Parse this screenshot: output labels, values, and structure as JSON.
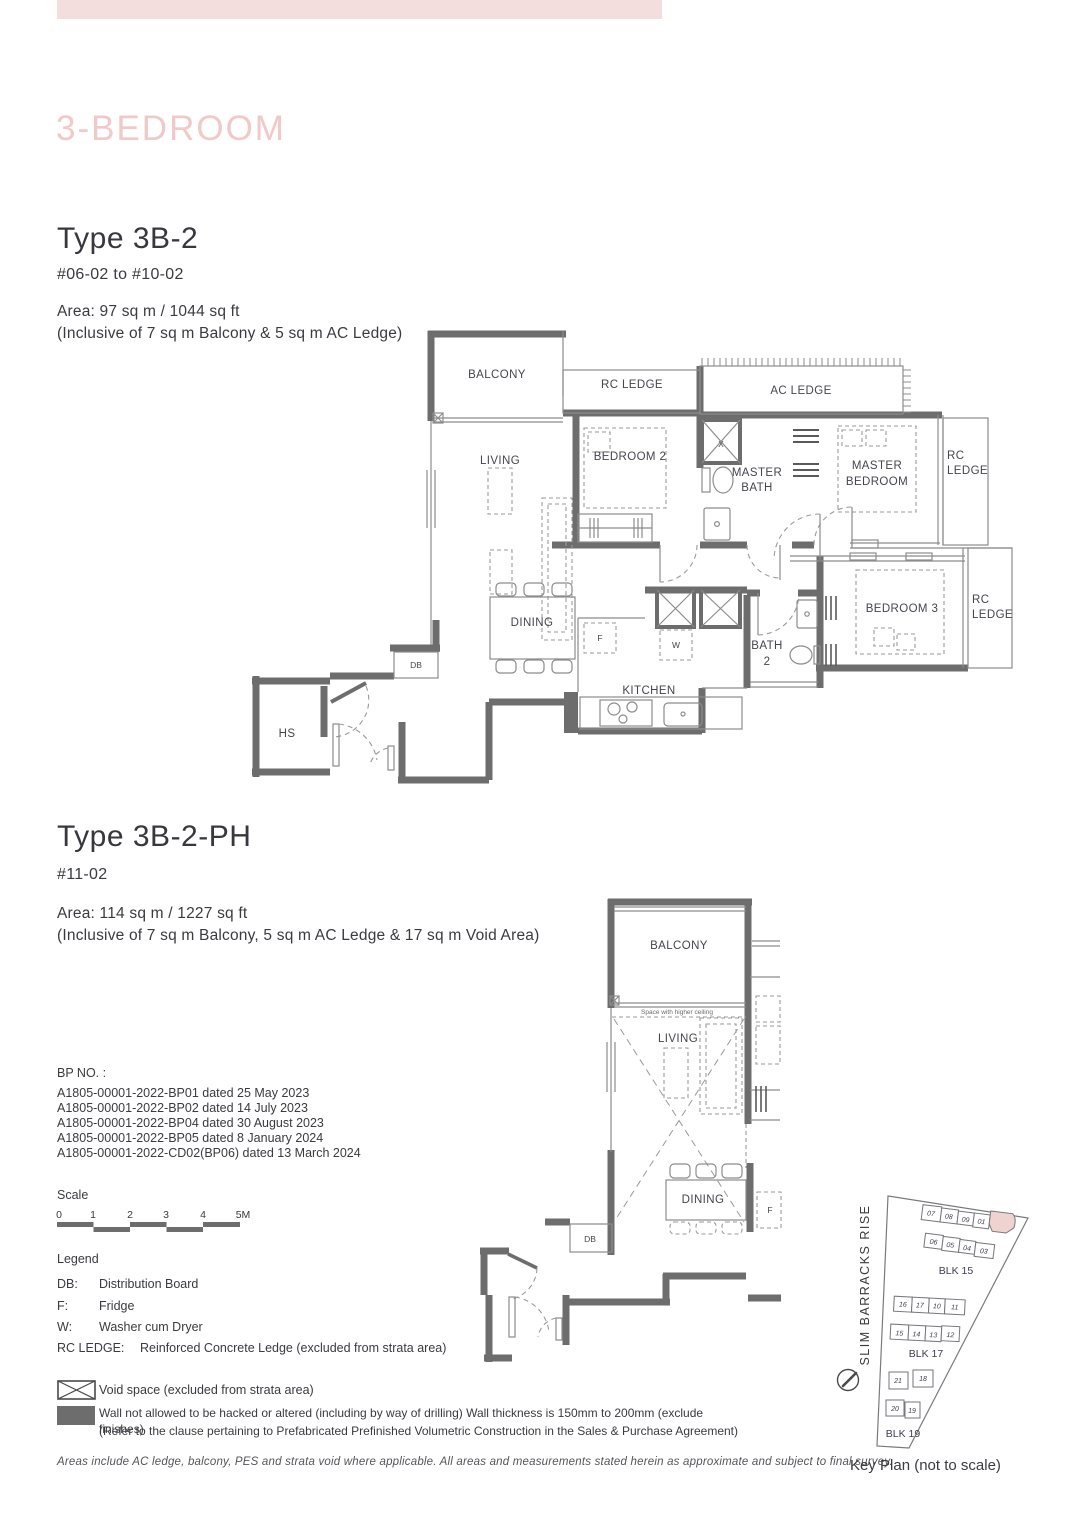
{
  "page": {
    "top_bar_color": "#f3dedd",
    "title": "3-BEDROOM",
    "footer": "Areas include AC ledge, balcony, PES and strata void where applicable. All areas and measurements stated herein as approximate and subject to final survey."
  },
  "unit_a": {
    "title": "Type 3B-2",
    "floors": "#06-02 to #10-02",
    "area1": "Area: 97 sq m / 1044 sq ft",
    "area2": "(Inclusive of 7 sq m Balcony & 5 sq m AC Ledge)"
  },
  "unit_b": {
    "title": "Type 3B-2-PH",
    "floors": "#11-02",
    "area1": "Area: 114 sq m / 1227 sq ft",
    "area2": "(Inclusive of 7 sq m Balcony, 5 sq m AC Ledge & 17 sq m Void Area)"
  },
  "bp": {
    "heading": "BP NO. :",
    "items": [
      "A1805-00001-2022-BP01 dated 25 May 2023",
      "A1805-00001-2022-BP02 dated 14 July 2023",
      "A1805-00001-2022-BP04 dated 30 August 2023",
      "A1805-00001-2022-BP05 dated 8 January 2024",
      "A1805-00001-2022-CD02(BP06) dated 13 March 2024"
    ]
  },
  "scale": {
    "label": "Scale",
    "ticks": [
      "0",
      "1",
      "2",
      "3",
      "4",
      "5M"
    ]
  },
  "legend": {
    "heading": "Legend",
    "items": [
      {
        "abbr": "DB:",
        "desc": "Distribution Board"
      },
      {
        "abbr": "F:",
        "desc": "Fridge"
      },
      {
        "abbr": "W:",
        "desc": "Washer cum Dryer"
      },
      {
        "abbr": "RC LEDGE:",
        "desc": "Reinforced Concrete Ledge (excluded from strata area)"
      }
    ],
    "void_note": "Void space (excluded from strata area)",
    "wall_note1": "Wall not allowed to be hacked or altered (including by way of drilling) Wall thickness is 150mm to 200mm (exclude finishes)",
    "wall_note2": "(Refer to the clause pertaining to Prefabricated Prefinished Volumetric Construction in the Sales & Purchase Agreement)"
  },
  "labels": {
    "balcony": "BALCONY",
    "rc_ledge": "RC LEDGE",
    "ac_ledge": "AC LEDGE",
    "living": "LIVING",
    "bedroom2": "BEDROOM 2",
    "bedroom3": "BEDROOM 3",
    "master": "MASTER",
    "bedroom_word": "BEDROOM",
    "bath": "BATH",
    "bath2_no": "2",
    "rc": "RC",
    "ledge": "LEDGE",
    "dining": "DINING",
    "kitchen": "KITCHEN",
    "db": "DB",
    "hs": "HS",
    "fridge": "F",
    "washer": "W",
    "void_x": "X",
    "higher_ceiling": "Space with higher ceiling"
  },
  "key_plan": {
    "street": "SLIM BARRACKS RISE",
    "caption": "Key Plan (not to scale)",
    "highlight_color": "#eed3d1",
    "blk15": {
      "name": "BLK 15",
      "row1": [
        "07",
        "08",
        "09",
        "01"
      ],
      "row2": [
        "06",
        "05",
        "04",
        "03"
      ]
    },
    "blk17": {
      "name": "BLK 17",
      "row1": [
        "16",
        "17",
        "10",
        "11"
      ],
      "row2": [
        "15",
        "14",
        "13",
        "12"
      ]
    },
    "blk19": {
      "name": "BLK 19",
      "row1": [
        "21",
        "18"
      ],
      "row2": [
        "20",
        "19"
      ]
    }
  }
}
